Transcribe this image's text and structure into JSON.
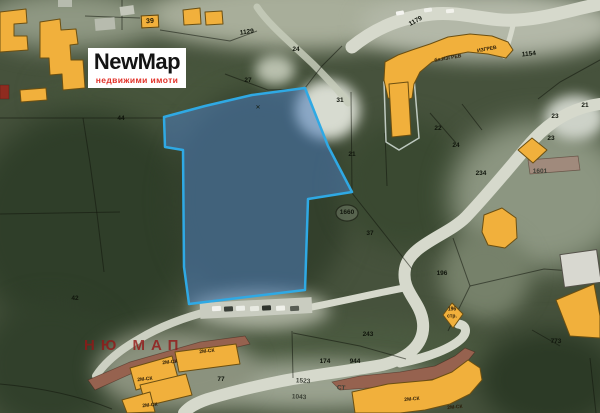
{
  "logo": {
    "title": "NewMap",
    "subtitle": "недвижими имоти"
  },
  "watermark": "НЮ МАП",
  "map": {
    "chip_label": "39",
    "highlight_parcel": {
      "stroke": "#2fa9e4",
      "fill": "rgba(76,126,189,0.55)"
    },
    "building_color": "#f1b03c",
    "labels": [
      {
        "text": "1129",
        "x": 247,
        "y": 33,
        "rot": -8
      },
      {
        "text": "24",
        "x": 296,
        "y": 50
      },
      {
        "text": "27",
        "x": 248,
        "y": 81
      },
      {
        "text": "31",
        "x": 340,
        "y": 101
      },
      {
        "text": "21",
        "x": 352,
        "y": 155
      },
      {
        "text": "22",
        "x": 438,
        "y": 129
      },
      {
        "text": "24",
        "x": 456,
        "y": 146
      },
      {
        "text": "23",
        "x": 555,
        "y": 117
      },
      {
        "text": "23",
        "x": 551,
        "y": 139
      },
      {
        "text": "21",
        "x": 585,
        "y": 106
      },
      {
        "text": "234",
        "x": 481,
        "y": 174
      },
      {
        "text": "1601",
        "x": 540,
        "y": 172,
        "cls": "road"
      },
      {
        "text": "1660",
        "x": 347,
        "y": 213
      },
      {
        "text": "37",
        "x": 370,
        "y": 234
      },
      {
        "text": "42",
        "x": 75,
        "y": 299
      },
      {
        "text": "44",
        "x": 121,
        "y": 119
      },
      {
        "text": "196",
        "x": 442,
        "y": 274
      },
      {
        "text": "196",
        "x": 452,
        "y": 310,
        "cls": "bldg"
      },
      {
        "text": "стр.",
        "x": 452,
        "y": 317,
        "cls": "bldg"
      },
      {
        "text": "243",
        "x": 368,
        "y": 335
      },
      {
        "text": "174",
        "x": 325,
        "y": 362
      },
      {
        "text": "944",
        "x": 355,
        "y": 362
      },
      {
        "text": "1523",
        "x": 303,
        "y": 382,
        "rot": 3,
        "cls": "road"
      },
      {
        "text": "1043",
        "x": 299,
        "y": 398,
        "rot": 3,
        "cls": "road"
      },
      {
        "text": "СТ",
        "x": 341,
        "y": 389,
        "rot": 5,
        "cls": "road"
      },
      {
        "text": "773",
        "x": 556,
        "y": 342
      },
      {
        "text": "77",
        "x": 221,
        "y": 380
      },
      {
        "text": "1179",
        "x": 416,
        "y": 22,
        "rot": -28
      },
      {
        "text": "1154",
        "x": 529,
        "y": 55,
        "rot": -6
      },
      {
        "text": "бл.ИЗГРЕВ",
        "x": 448,
        "y": 59,
        "rot": -10,
        "cls": "bldg"
      },
      {
        "text": "ИЗГРЕВ",
        "x": 487,
        "y": 50,
        "rot": -10,
        "cls": "bldg"
      },
      {
        "text": "2М-СК",
        "x": 207,
        "y": 352,
        "rot": -6,
        "cls": "bldg"
      },
      {
        "text": "2М-СК",
        "x": 170,
        "y": 363,
        "rot": -6,
        "cls": "bldg"
      },
      {
        "text": "2М-СК",
        "x": 145,
        "y": 380,
        "rot": -6,
        "cls": "bldg"
      },
      {
        "text": "2М-СК",
        "x": 150,
        "y": 406,
        "rot": -6,
        "cls": "bldg"
      },
      {
        "text": "2М-СК",
        "x": 412,
        "y": 400,
        "rot": -5,
        "cls": "bldg"
      },
      {
        "text": "2М-СК",
        "x": 455,
        "y": 408,
        "rot": -5,
        "cls": "bldg"
      },
      {
        "text": "✕",
        "x": 258,
        "y": 108,
        "cls": "marker"
      }
    ]
  }
}
